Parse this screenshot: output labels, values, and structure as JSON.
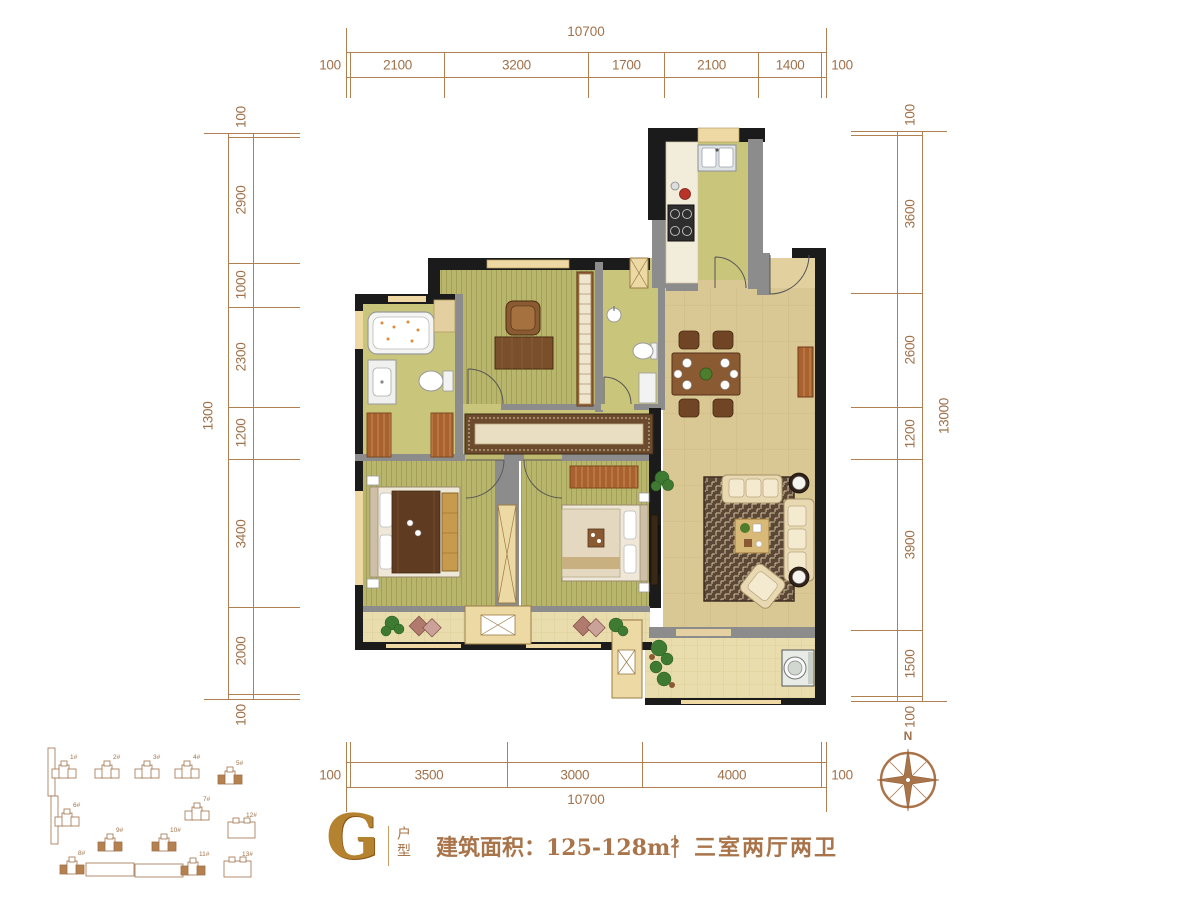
{
  "dimensions": {
    "top": {
      "total": "10700",
      "segments": [
        "100",
        "2100",
        "3200",
        "1700",
        "2100",
        "1400",
        "100"
      ]
    },
    "bottom": {
      "total": "10700",
      "segments": [
        "100",
        "3500",
        "3000",
        "4000",
        "100"
      ]
    },
    "left": {
      "total": "1300",
      "segments": [
        "100",
        "2900",
        "1000",
        "2300",
        "1200",
        "3400",
        "2000",
        "100"
      ]
    },
    "right": {
      "total": "13000",
      "segments": [
        "100",
        "3600",
        "2600",
        "1200",
        "3900",
        "1500",
        "100"
      ]
    }
  },
  "title_block": {
    "unit_letter": "G",
    "unit_type_label": "户型",
    "area_label": "建筑面积：125-128m²",
    "separator": "｜",
    "layout_label": "三室两厅两卫"
  },
  "compass": {
    "north_label": "N"
  },
  "site_plan": {
    "buildings": [
      {
        "label": "1#",
        "x": 14,
        "y": 22,
        "type": "cluster",
        "vbar": true,
        "filled": false
      },
      {
        "label": "2#",
        "x": 57,
        "y": 22,
        "type": "cluster",
        "filled": false
      },
      {
        "label": "3#",
        "x": 97,
        "y": 22,
        "type": "cluster",
        "filled": false
      },
      {
        "label": "4#",
        "x": 137,
        "y": 22,
        "type": "cluster",
        "filled": false
      },
      {
        "label": "5#",
        "x": 180,
        "y": 28,
        "type": "cluster",
        "filled": true
      },
      {
        "label": "6#",
        "x": 17,
        "y": 70,
        "type": "cluster",
        "vbar": true,
        "filled": false
      },
      {
        "label": "7#",
        "x": 147,
        "y": 64,
        "type": "cluster",
        "filled": false
      },
      {
        "label": "12#",
        "x": 190,
        "y": 80,
        "type": "outline",
        "filled": false
      },
      {
        "label": "9#",
        "x": 60,
        "y": 95,
        "type": "cluster",
        "filled": true
      },
      {
        "label": "10#",
        "x": 114,
        "y": 95,
        "type": "cluster",
        "filled": true
      },
      {
        "label": "8#",
        "x": 22,
        "y": 118,
        "type": "cluster",
        "filled": true,
        "hbar": 26
      },
      {
        "label": "11#",
        "x": 143,
        "y": 119,
        "type": "cluster",
        "filled": true,
        "hbar": -46
      },
      {
        "label": "13#",
        "x": 186,
        "y": 119,
        "type": "outline",
        "filled": false
      }
    ]
  },
  "colors": {
    "dimension_text": "#a0714a",
    "wall_black": "#1b1b1b",
    "wall_gray": "#8c8c8c",
    "window_tan": "#eed9a4",
    "floor_green": "#c9c67c",
    "floor_tan": "#d9c794",
    "gold": "#b5832f"
  }
}
